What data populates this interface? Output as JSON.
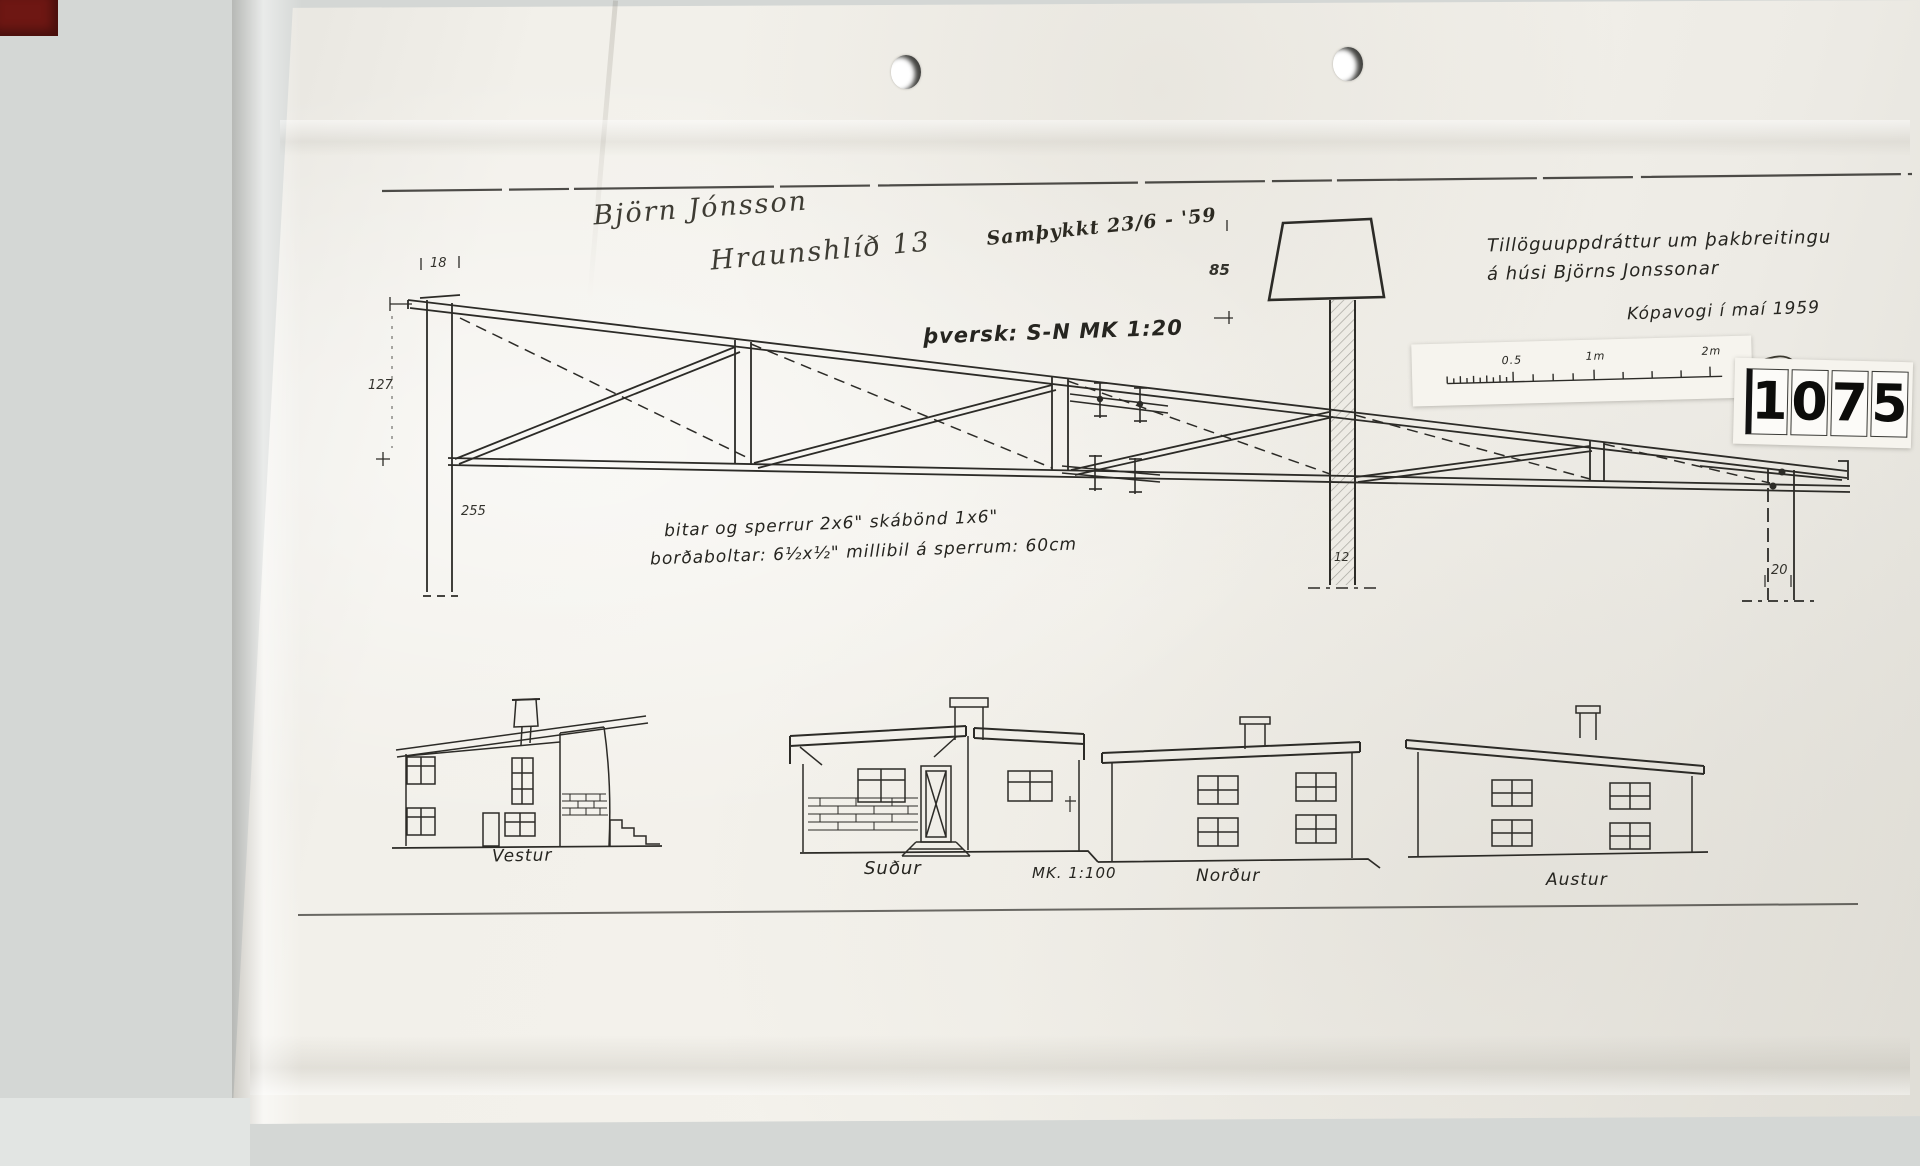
{
  "handwritten": {
    "name": "Björn Jónsson",
    "address": "Hraunshlíð 13",
    "approval": "Samþykkt 23/6 - '59"
  },
  "title_block": {
    "line1": "Tillöguuppdráttur um þakbreitingu",
    "line2": "á húsi Björns Jonssonar",
    "place_date": "Kópavogi í maí 1959"
  },
  "stamp": {
    "digits": [
      "1",
      "0",
      "7",
      "5"
    ]
  },
  "scale_bar": {
    "labels": [
      "0.5",
      "1m",
      "2m"
    ]
  },
  "truss": {
    "section_label": "þversk: S-N MK 1:20",
    "note_line1": "bitar og sperrur 2x6\"  skábönd 1x6\"",
    "note_line2": "borðaboltar: 6½x½\"   millibil á sperrum: 60cm",
    "dimensions": {
      "top_left": "18",
      "left": "127",
      "bottom_left": "255",
      "chimney_height": "85",
      "chimney_width": "12",
      "right_post": "20"
    }
  },
  "elevations": {
    "scale_label": "MK. 1:100",
    "labels": [
      "Vestur",
      "Suður",
      "Norður",
      "Austur"
    ]
  }
}
